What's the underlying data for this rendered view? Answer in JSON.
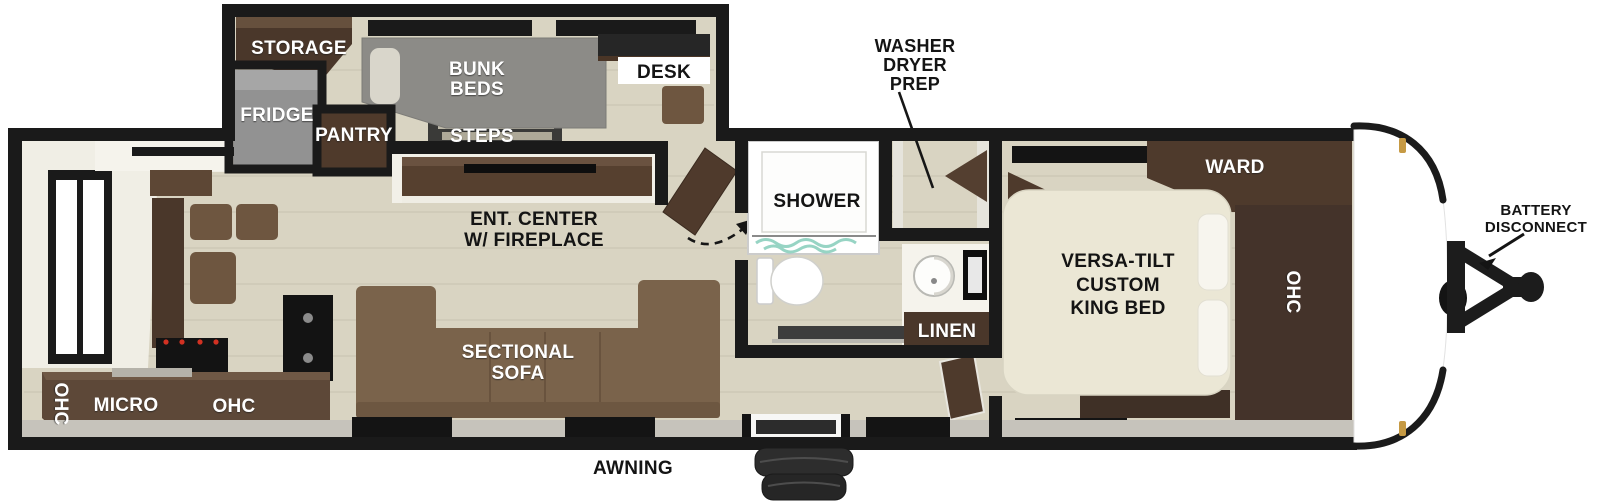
{
  "title": "Travel trailer floor plan with bunkhouse, rear kitchen and front king bedroom",
  "labels": {
    "storage": "STORAGE",
    "fridge": "FRIDGE",
    "pantry": "PANTRY",
    "bunk_beds": [
      "BUNK",
      "BEDS"
    ],
    "steps": "STEPS",
    "desk": "DESK",
    "washer_dryer_prep": [
      "WASHER",
      "DRYER",
      "PREP"
    ],
    "shower": "SHOWER",
    "linen": "LINEN",
    "ward": "WARD",
    "bedroom_ohc": "OHC",
    "king_bed": [
      "VERSA-TILT",
      "CUSTOM",
      "KING BED"
    ],
    "battery_disconnect": [
      "BATTERY",
      "DISCONNECT"
    ],
    "ent_center": [
      "ENT. CENTER",
      "W/ FIREPLACE"
    ],
    "sectional_sofa": [
      "SECTIONAL",
      "SOFA"
    ],
    "rear_ohc": "OHC",
    "micro": "MICRO",
    "kitchen_ohc": "OHC",
    "awning": "AWNING"
  },
  "colors": {
    "wall": "#1a1a1a",
    "floor": "#d9d4c2",
    "plank_line": "#c7c2af",
    "white_room": "#f5f3ec",
    "cabinet_dark": "#4a372a",
    "cabinet_mid": "#5d4735",
    "cabinet_light": "#6e5640",
    "sofa": "#7a634b",
    "mattress_gray": "#8c8b87",
    "fridge_gray": "#929292",
    "bed_cream": "#ebe7d5",
    "shower_teal": "#85ccba",
    "marker_gold": "#c69a44"
  }
}
